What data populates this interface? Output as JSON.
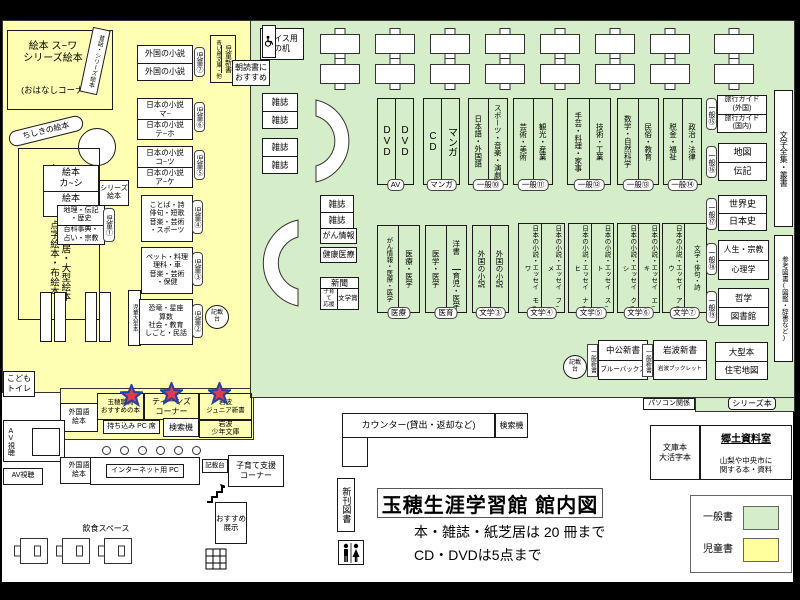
{
  "colors": {
    "children_yellow": "#ffffb4",
    "general_green": "#d5edc8",
    "search_pink": "#f7a0c4",
    "star_red": "#e03a4e",
    "star_blue": "#2b3f9e"
  },
  "title": {
    "main": "玉穂生涯学習館 館内図",
    "note1": "本・雑誌・紙芝居は 20 冊まで",
    "note2": "CD・DVDは5点まで"
  },
  "legend": {
    "general": "一般書",
    "children": "児童書"
  },
  "children": {
    "ehon_suwa": "絵本 ス~ワ\nシリーズ絵本",
    "ohanashi": "(おはなしコーナー)",
    "mukashi": "昔話・シリーズ絵本",
    "chishiki": "ちしきの絵本",
    "shelf_col1": "シリーズ本・点字絵本・布絵本・",
    "shelf_col2": "紙芝居・大型紙芝居・大型絵本",
    "ehon_kashi": "絵本\nカ~シ",
    "ehon_ao": "絵本\nア~オ",
    "series_ehon": "シリーズ\n絵本",
    "chiri_r1": "地理・伝記\n・歴史",
    "chiri_r2": "百科事典・\n占い・宗教",
    "tag1": "児童①",
    "jido_ogata": "児童大型本",
    "foreign1": "外国の小説",
    "foreign2": "外国の小説",
    "tag7": "児童⑦",
    "jp_ma": "日本の小説\nマ~",
    "jp_teho": "日本の小説\nテ~ホ",
    "tag6": "児童⑥",
    "jp_kotsu": "日本の小説\nコ~ツ",
    "jp_ake": "日本の小説\nア~ケ",
    "tag5": "児童⑤",
    "kotoba": "ことば・詩\n俳句・短歌\n音楽・芸術\n・スポーツ",
    "tag4": "児童④",
    "pet": "ペット・料理\n理科・車\n音楽・芸術\n・保健",
    "tag3": "児童③",
    "dino": "恐竜・星座\n算数\n社会・教育\nしごと・民話",
    "tag2": "児童②",
    "kisaidai": "記載\n台",
    "aoitori": "青い鳥文庫・他",
    "jido_shinsho": "児童新書",
    "asadoku": "朝読書に\nおすすめ",
    "kodomo_toilet": "こども\nトイレ"
  },
  "top": {
    "wheelchair_desk": "車イス用\nの机",
    "magazine": "雑誌"
  },
  "general": {
    "gan_info": "がん情報",
    "kenko": "健康医療",
    "shinbun": "新聞",
    "kosodate_ouen": "子育て\n応援",
    "bungakusho": "文学賞",
    "pairs": [
      {
        "c1": "DVD",
        "c2": "DVD",
        "tag": "AV"
      },
      {
        "c1": "CD",
        "c2": "マンガ",
        "tag": "マンガ"
      },
      {
        "c1": "日本語・外国語",
        "c2": "スポーツ・音楽・演劇",
        "tag": "一般⑩"
      },
      {
        "c1": "芸術・美術",
        "c2": "観光・産業",
        "tag": "一般⑪"
      },
      {
        "c1": "手芸・料理・家事",
        "c2": "技術・工業",
        "tag": "一般⑫"
      },
      {
        "c1": "数学・自然科学",
        "c2": "民俗・教育",
        "tag": "一般⑬"
      },
      {
        "c1": "税金・福祉",
        "c2": "政治・法律",
        "tag": "一般⑭"
      },
      {
        "c1": "がん情報・医療・医学",
        "c2": "医療・医学",
        "tag": "医療"
      },
      {
        "c1": "医学・医学",
        "c2a": "洋書",
        "c2b": "育児・医学",
        "tag": "医育"
      },
      {
        "c1": "外国の小説",
        "c2": "外国の小説",
        "tag": "文学③"
      },
      {
        "c1": "日本の小説・エッセイ モ~ワ",
        "c2": "日本の小説・エッセイ フ~メ",
        "tag": "文学④"
      },
      {
        "c1": "日本の小説・エッセイ ナ~ヒ",
        "c2": "日本の小説・エッセイ ス~ト",
        "tag": "文学⑤"
      },
      {
        "c1": "日本の小説・エッセイ ク~シ",
        "c2": "日本の小説・エッセイ エ~キ",
        "tag": "文学⑥"
      },
      {
        "c1": "日本の小説・エッセイ ア~ウ",
        "c2": "文学・俳句・詩",
        "tag": "文学⑦"
      }
    ],
    "stacks": [
      {
        "r1": "旅行ガイド\n(外国)",
        "r2": "旅行ガイド\n(国内)",
        "tag": "一般⑮"
      },
      {
        "r1": "地図",
        "r2": "伝記",
        "tag": "一般⑯"
      },
      {
        "r1": "世界史",
        "r2": "日本史",
        "tag": "一般⑰"
      },
      {
        "r1": "人生・宗教",
        "r2": "心理学",
        "tag": "一般⑱"
      },
      {
        "r1": "哲学",
        "r2": "図書館",
        "tag": "一般⑲"
      }
    ],
    "bungaku_zenshu": "文学全集・叢書",
    "sanko": "参考図書(図鑑・辞書など)",
    "kisaidai": "記載\n台",
    "chuko_r1": "中公新書",
    "chuko_r2": "ブルーバックス",
    "iwanami_r1": "岩波新書",
    "iwanami_r2": "岩波ブックレット",
    "shinsho_tag": "一般新書",
    "ogata_r1": "大型本",
    "ogata_r2": "住宅地図",
    "series": "シリーズ本",
    "pc": "パソコン関係"
  },
  "service": {
    "counter": "カウンター(貸出・返却など)",
    "search": "検索機",
    "bunko": "文庫本\n大活字本",
    "kyodo_title": "郷土資料室",
    "kyodo_sub": "山梨や中央市に\n関する本・資料",
    "shinkan": "新刊図書",
    "av": "AV視聴",
    "foreign_ehon": "外国語\n絵本",
    "staff": "玉穂職員\nおすすめの本",
    "teens": "ティーンズ\nコーナー",
    "iwanami_jr": "岩波\nジュニア新書",
    "mochikomi": "持ち込み PC 席",
    "iwanami_shonen": "岩波\n少年文庫",
    "internet": "インターネット用 PC",
    "kisaidai": "記載台",
    "kosodate": "子育て支援\nコーナー",
    "osusume": "おすすめ\n展示",
    "inshoku": "飲食スペース"
  }
}
